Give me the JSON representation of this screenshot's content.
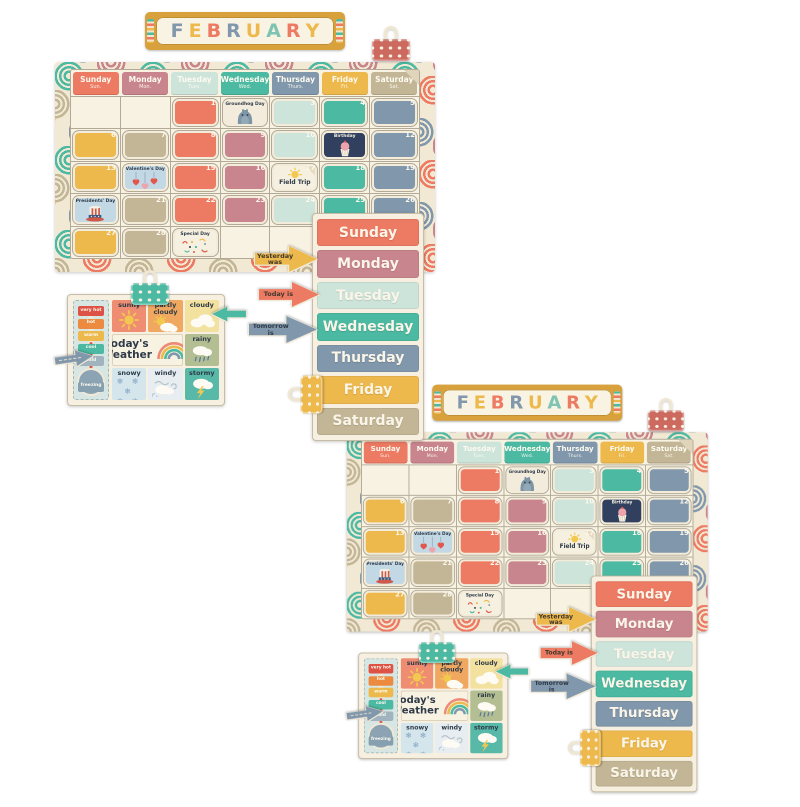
{
  "banner": {
    "letters": [
      {
        "ch": "F",
        "color": "#8197ab"
      },
      {
        "ch": "E",
        "color": "#edb94d"
      },
      {
        "ch": "B",
        "color": "#ed7a62"
      },
      {
        "ch": "R",
        "color": "#8197ab"
      },
      {
        "ch": "U",
        "color": "#edb94d"
      },
      {
        "ch": "A",
        "color": "#7fc4b2"
      },
      {
        "ch": "R",
        "color": "#ed7a62"
      },
      {
        "ch": "Y",
        "color": "#edb94d"
      }
    ]
  },
  "palette": {
    "cream": "#f8f2e3",
    "gold": "#d8a13c",
    "coral": "#ed7a62",
    "rose": "#c9858d",
    "mint": "#cde4da",
    "teal": "#4cb9a2",
    "slate": "#8197ab",
    "yellow": "#edb94d",
    "tan": "#c3b696",
    "navy": "#2e3a48",
    "pale_blue": "#c3d8e5",
    "clip_red": "#cc6a60"
  },
  "calendar": {
    "day_headers": [
      {
        "full": "Sunday",
        "abbr": "Sun.",
        "color": "#ed7a62"
      },
      {
        "full": "Monday",
        "abbr": "Mon.",
        "color": "#c9858d"
      },
      {
        "full": "Tuesday",
        "abbr": "Tues.",
        "color": "#cde4da"
      },
      {
        "full": "Wednesday",
        "abbr": "Wed.",
        "color": "#4cb9a2"
      },
      {
        "full": "Thursday",
        "abbr": "Thurs.",
        "color": "#8197ab"
      },
      {
        "full": "Friday",
        "abbr": "Fri.",
        "color": "#edb94d"
      },
      {
        "full": "Saturday",
        "abbr": "Sat.",
        "color": "#c3b696"
      }
    ],
    "cells": [
      {},
      {},
      {
        "num": "1",
        "fill": "#ed7a62"
      },
      {
        "num": "2",
        "sticker": "groundhog"
      },
      {
        "num": "3",
        "fill": "#cde4da"
      },
      {
        "num": "4",
        "fill": "#4cb9a2"
      },
      {
        "num": "5",
        "fill": "#8197ab"
      },
      {
        "num": "6",
        "fill": "#edb94d"
      },
      {
        "num": "7",
        "fill": "#c3b696"
      },
      {
        "num": "8",
        "fill": "#ed7a62"
      },
      {
        "num": "9",
        "fill": "#c9858d"
      },
      {
        "num": "10",
        "fill": "#cde4da"
      },
      {
        "num": "11",
        "sticker": "birthday"
      },
      {
        "num": "12",
        "fill": "#8197ab"
      },
      {
        "num": "13",
        "fill": "#edb94d"
      },
      {
        "num": "14",
        "sticker": "valentine"
      },
      {
        "num": "15",
        "fill": "#ed7a62"
      },
      {
        "num": "16",
        "fill": "#c9858d"
      },
      {
        "num": "17",
        "sticker": "fieldtrip"
      },
      {
        "num": "18",
        "fill": "#4cb9a2"
      },
      {
        "num": "19",
        "fill": "#8197ab"
      },
      {
        "num": "20",
        "sticker": "presidents"
      },
      {
        "num": "21",
        "fill": "#c3b696"
      },
      {
        "num": "22",
        "fill": "#ed7a62"
      },
      {
        "num": "23",
        "fill": "#c9858d"
      },
      {
        "num": "24",
        "fill": "#cde4da"
      },
      {
        "num": "25",
        "fill": "#4cb9a2"
      },
      {
        "num": "26",
        "fill": "#8197ab"
      },
      {
        "num": "27",
        "fill": "#edb94d"
      },
      {
        "num": "28",
        "fill": "#c3b696"
      },
      {
        "sticker": "special"
      },
      {},
      {},
      {},
      {}
    ]
  },
  "stickers": {
    "groundhog": {
      "label": "Groundhog Day",
      "bg": "#f3ecdc"
    },
    "birthday": {
      "label": "Birthday",
      "bg": "#31405e"
    },
    "valentine": {
      "label": "Valentine's Day",
      "bg": "#c3d8e5"
    },
    "fieldtrip": {
      "label": "Field Trip",
      "bg": "#f6f0e0"
    },
    "presidents": {
      "label": "Presidents' Day",
      "bg": "#c3d8e5"
    },
    "special": {
      "label": "Special Day",
      "bg": "#f6f0e0"
    }
  },
  "day_strips": [
    {
      "label": "Sunday",
      "color": "#ed7a62"
    },
    {
      "label": "Monday",
      "color": "#c9858d"
    },
    {
      "label": "Tuesday",
      "color": "#cde4da"
    },
    {
      "label": "Wednesday",
      "color": "#4cb9a2"
    },
    {
      "label": "Thursday",
      "color": "#8197ab"
    },
    {
      "label": "Friday",
      "color": "#edb94d"
    },
    {
      "label": "Saturday",
      "color": "#c3b696"
    }
  ],
  "arrows": {
    "yesterday": {
      "label": "Yesterday was",
      "color": "#edb94d"
    },
    "today": {
      "label": "Today is",
      "color": "#ed7a62"
    },
    "tomorrow": {
      "label": "Tomorrow is",
      "color": "#8197ab"
    }
  },
  "weather": {
    "title_line1": "Today's",
    "title_line2": "Weather",
    "tiles": [
      {
        "key": "sunny",
        "label": "sunny",
        "bg": "#ef8d73"
      },
      {
        "key": "partly",
        "label": "partly cloudy",
        "bg": "#f0a860"
      },
      {
        "key": "cloudy",
        "label": "cloudy",
        "bg": "#f3e1a0"
      },
      {
        "key": "title",
        "label": ""
      },
      {
        "key": "rainy",
        "label": "rainy",
        "bg": "#b3bf92"
      },
      {
        "key": "snowy",
        "label": "snowy",
        "bg": "#d5e5ec"
      },
      {
        "key": "windy",
        "label": "windy",
        "bg": "#e7edf0"
      },
      {
        "key": "stormy",
        "label": "stormy",
        "bg": "#58b9a9"
      }
    ],
    "thermometer": [
      {
        "label": "very hot",
        "color": "#dd5244"
      },
      {
        "label": "hot",
        "color": "#ec8b3f"
      },
      {
        "label": "warm",
        "color": "#edb94d"
      },
      {
        "label": "cool",
        "color": "#4cb9a2"
      },
      {
        "label": "cold",
        "color": "#9fb4bf"
      },
      {
        "label": "freezing",
        "color": "#87a0b0"
      }
    ]
  }
}
